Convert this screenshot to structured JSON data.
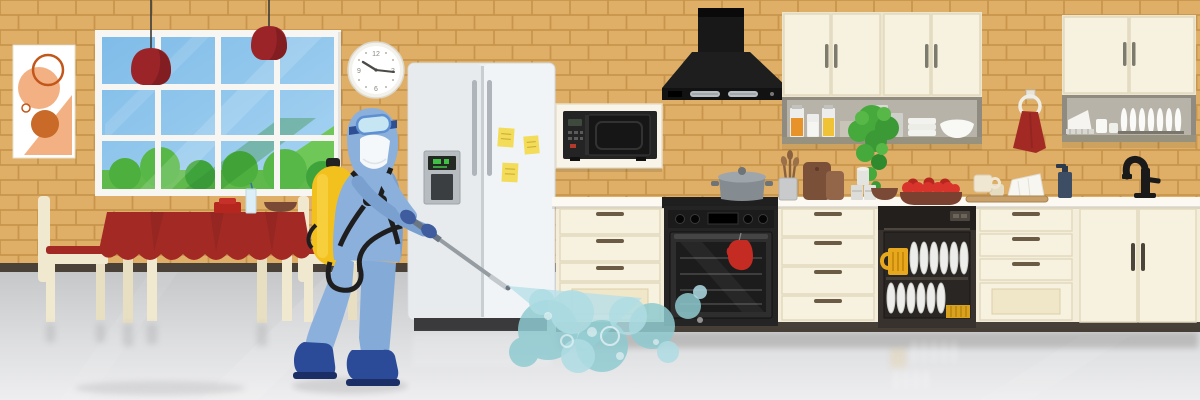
{
  "scene": {
    "title": "Kitchen disinfection illustration",
    "description": "Worker in a blue protective suit with a yellow sprayer tank sprays disinfectant mist in a kitchen with brick walls, a window, dining table, refrigerator, microwave, range hood, oven, dishwasher and cream cabinets",
    "clock": {
      "numerals": {
        "top": "12",
        "right": "3",
        "bottom": "6",
        "left": "9"
      }
    },
    "fridge": {
      "sticky_notes": 3
    },
    "palette": {
      "brick": "#DFAF67",
      "mortar": "#C8954B",
      "baseboard": "#4A4238",
      "floor_top": "#C6C7C9",
      "floor_bottom": "#EEEEF0",
      "cabinet_cream": "#F6EFDC",
      "counter_white": "#FBF9F1",
      "appliance_black": "#1E1E1E",
      "fridge_gray": "#EFF2F4",
      "accent_red": "#A32A24",
      "suit_blue": "#8CB0DC",
      "tank_yellow": "#F3C11D",
      "spray_teal": "#8FCBD0",
      "plant_green": "#46A93C",
      "sticky_yellow": "#F2DC5A",
      "sky_blue": "#8FC6EC",
      "bush_green": "#53B648",
      "wood_brown": "#7A5038",
      "tomato_red": "#D8342C"
    }
  }
}
